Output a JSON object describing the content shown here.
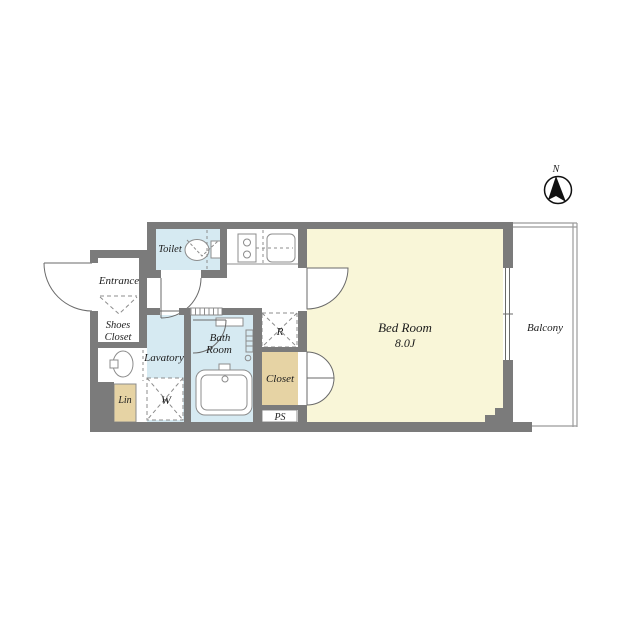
{
  "plan": {
    "compass": {
      "label": "N"
    },
    "rooms": {
      "toilet": {
        "label": "Toilet"
      },
      "entrance": {
        "label": "Entrance"
      },
      "shoes_closet": {
        "line1": "Shoes",
        "line2": "Closet"
      },
      "lavatory": {
        "label": "Lavatory"
      },
      "bath_room": {
        "line1": "Bath",
        "line2": "Room"
      },
      "bed_room": {
        "label": "Bed Room",
        "size": "8.0J"
      },
      "balcony": {
        "label": "Balcony"
      },
      "closet": {
        "label": "Closet"
      },
      "linen": {
        "label": "Lin"
      },
      "washer_space": {
        "label": "W"
      },
      "fridge_space": {
        "label": "R"
      },
      "pipe_space": {
        "label": "PS"
      }
    },
    "colors": {
      "wall": "#7b7b7b",
      "wet_room": "#d6eaf2",
      "bedroom": "#f9f6d8",
      "storage": "#e6d3a4",
      "fixture_line": "#8c8c8c",
      "door_line": "#6a6a6a",
      "balcony_line": "#9b9b9b",
      "text": "#1c1c1c",
      "compass": "#111111"
    }
  }
}
